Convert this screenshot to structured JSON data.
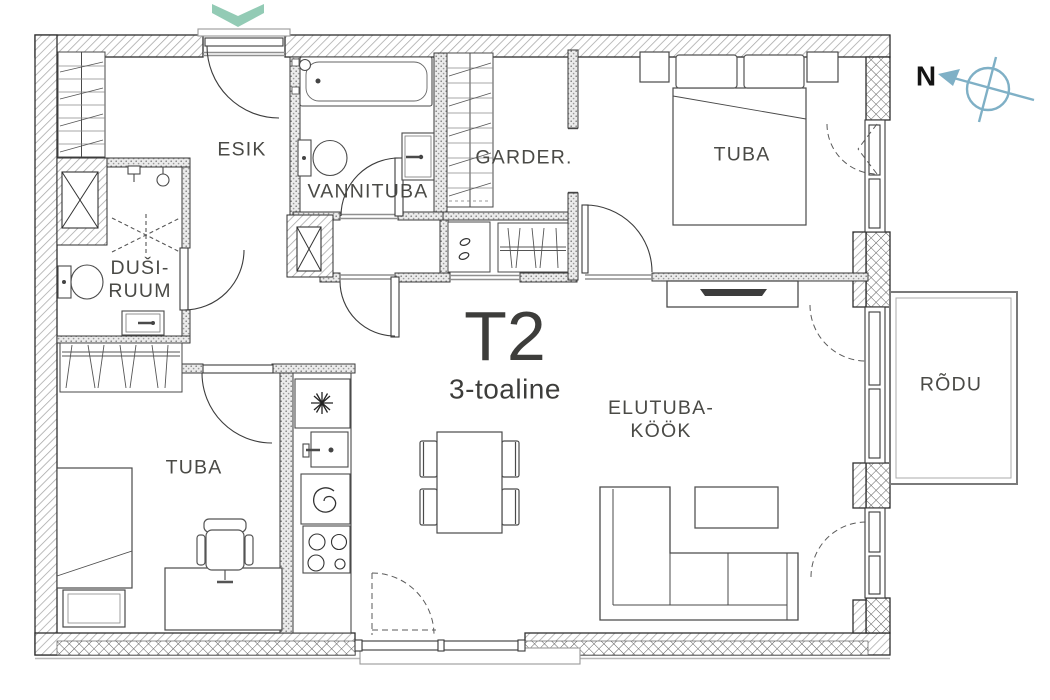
{
  "plan": {
    "title": "T2",
    "subtitle": "3-toaline"
  },
  "rooms": {
    "esik": "ESIK",
    "vannituba": "VANNITUBA",
    "garder": "GARDER.",
    "tuba_top": "TUBA",
    "dusiruum": {
      "line1": "DUŠI-",
      "line2": "RUUM"
    },
    "tuba_bottom": "TUBA",
    "elutuba": {
      "line1": "ELUTUBA-",
      "line2": "KÖÖK"
    },
    "rodu": "RÕDU"
  },
  "compass": {
    "north": "N"
  },
  "colors": {
    "accent_teal": "#93cbb5",
    "compass_blue": "#7fb0c6",
    "wall_line": "#2e2e2e",
    "label": "#4a4a46"
  },
  "icons": {
    "entry_arrow": "chevron-down-icon",
    "compass": "compass-needle-icon",
    "fridge": "snowflake-icon",
    "oven": "spiral-icon",
    "cooktop": "burners-icon",
    "shower": "shower-icon",
    "washer": "water-drops-icon",
    "tv": "tv-icon"
  }
}
